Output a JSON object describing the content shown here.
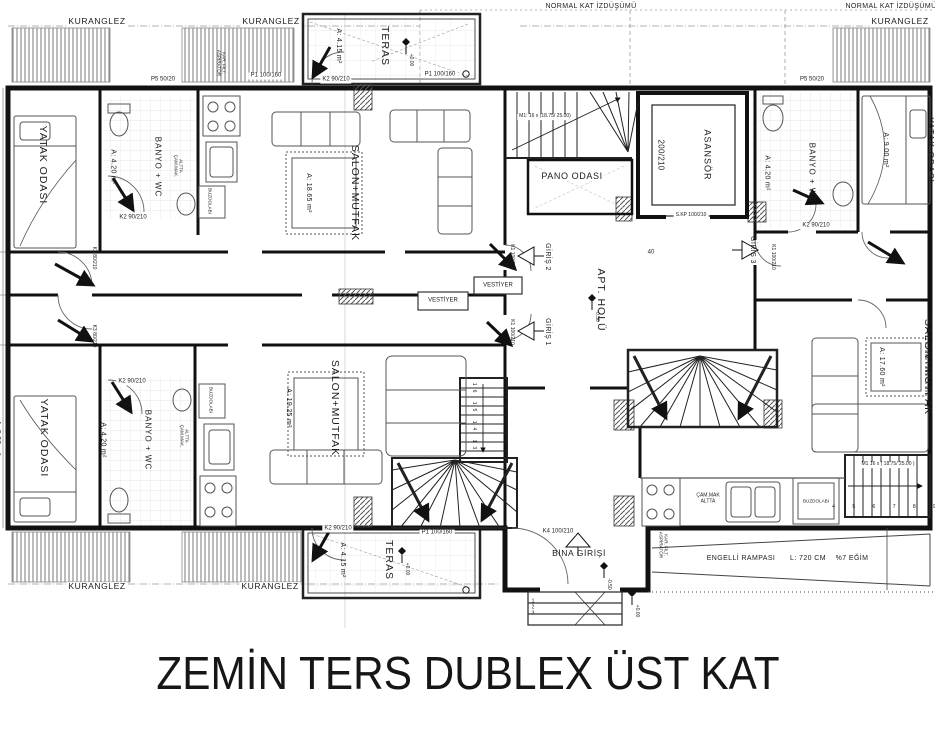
{
  "title": "ZEMİN TERS DUBLEX ÜST KAT",
  "projection": {
    "left": "NORMAL KAT İZDÜŞÜMÜ",
    "right": "NORMAL KAT İZDÜŞÜMÜ"
  },
  "kuranglez": {
    "t1": "KURANGLEZ",
    "t2": "KURANGLEZ",
    "tr": "KURANGLEZ",
    "b1": "KURANGLEZ",
    "b2": "KURANGLEZ"
  },
  "rooms": {
    "yatak_tl_name": "YATAK ODASI",
    "yatak_tl_area": "A: 9.30 m²",
    "banyo_tl_name": "BANYO + WC",
    "banyo_tl_area": "A: 4.20 m²",
    "salon_tl_name": "SALON+MUTFAK",
    "salon_tl_area": "A: 18.65 m²",
    "teras_top_name": "TERAS",
    "teras_top_area": "A: 4.15 m²",
    "pano_name": "PANO ODASI",
    "asansor_name": "ASANSÖR",
    "asansor_size": "200/210",
    "apt_holu": "APT. HOLÜ",
    "banyo_tr_name": "BANYO + WC",
    "banyo_tr_area": "A: 4.20 m²",
    "yatak_tr_name": "YATAK ODASI",
    "yatak_tr_area": "A: 9.00 m²",
    "salon_r_name": "SALON+MUTFAK",
    "salon_r_area": "A: 17.60 m²",
    "yatak_bl_name": "YATAK ODASI",
    "yatak_bl_area": "A: 9.90 m²",
    "banyo_bl_name": "BANYO + WC",
    "banyo_bl_area": "A: 4.20 m²",
    "salon_bl_name": "SALON+MUTFAK",
    "salon_bl_area": "A: 19.25 m²",
    "teras_bot_name": "TERAS",
    "teras_bot_area": "A: 4.15 m²",
    "vestiyer_1": "VESTİYER",
    "vestiyer_2": "VESTİYER",
    "bina_girisi": "BİNA GİRİŞİ",
    "giris_1": "GİRİŞ 1",
    "giris_2": "GİRİŞ 2",
    "giris_3": "GİRİŞ 3"
  },
  "tags": {
    "p5_tl": "P5 50/20",
    "p1_tl": "P1 100/160",
    "k2_banyo_tl": "K2 90/210",
    "k2_teras_top": "K2 90/210",
    "p1_teras_top": "P1 100/160",
    "p5_tr": "P5 50/20",
    "k2_banyo_tr": "K2 90/210",
    "k2_banyo_bl": "K2 90/210",
    "k2_teras_bot": "K2 90/210",
    "p1_teras_bot": "P1 100/160",
    "skp": "S.KP 100/210",
    "k4": "K4 100/210",
    "k3_a": "K3 80/210",
    "k3_b": "K3 80/210",
    "k1_a": "K1 100/210",
    "k1_b": "K1 100/210",
    "k1_c": "K1 100/210",
    "dim40": "40"
  },
  "appliances": {
    "buzdolabi_tl": "BUZDOLABI",
    "buzdolabi_bl": "BUZDOLABI",
    "buzdolabi_br": "BUZDOLABI",
    "cam_mak": "ÇAM.MAK\nALTTA",
    "alt_cam_tl": "ALTTA\nÇAM.MAK.",
    "alt_cam_bl": "ALTTA\nÇAM.MAK.",
    "aspirator_top": "KAR. FİLT.\nASPİRATÖR",
    "aspirator_bot": "KAR. FİLT.\nASPİRATÖR"
  },
  "levels": {
    "teras_top": "+0.00",
    "teras_bot": "+0.00",
    "hall": "-0.50",
    "porch": "-0.50",
    "outside": "+0.00"
  },
  "ramp": {
    "label": "ENGELLİ RAMPASI",
    "length": "L: 720 CM",
    "slope": "%7 EĞİM"
  },
  "stairs": {
    "m1_top": "M1: 16 x (18.75/ 25.00)",
    "m1_right": "M1 16 x ( 18.75/ 25.00 )",
    "run_left_numbers": "16 15 14 13",
    "run_right_numbers": "4 5 6 7 8 9",
    "entry_steps": "1\n2\n3"
  }
}
